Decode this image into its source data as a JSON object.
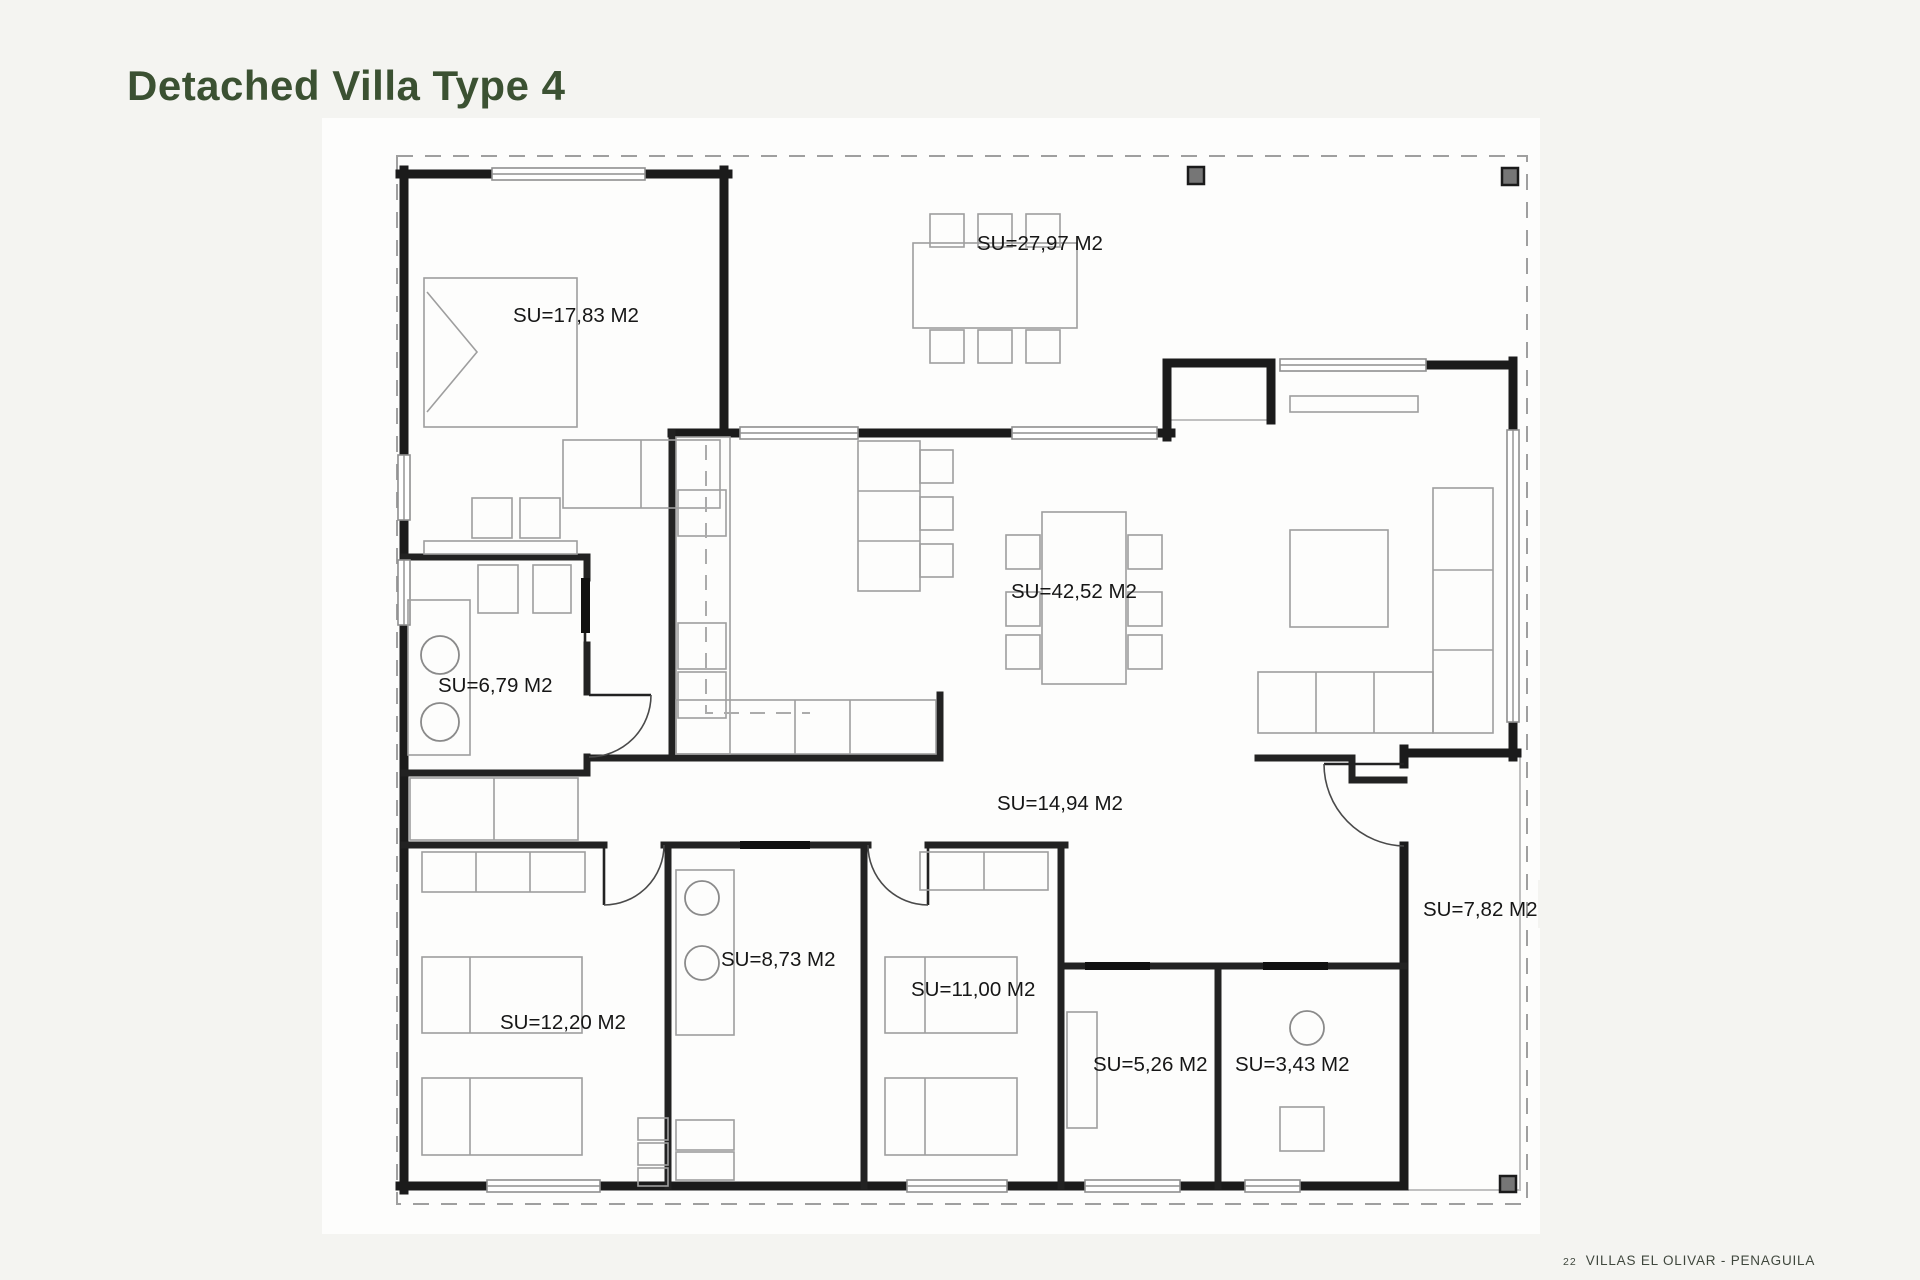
{
  "page": {
    "title": "Detached Villa Type 4",
    "background_color": "#f4f4f1",
    "title_color": "#3b5132"
  },
  "footer": {
    "page_number": "22",
    "project_name": "VILLAS EL OLIVAR - PENAGUILA"
  },
  "plan": {
    "area_unit": "M2",
    "rooms": [
      {
        "id": "bedroom-main",
        "label": "SU=17,83 M2",
        "area_m2": "17,83"
      },
      {
        "id": "terrace",
        "label": "SU=27,97 M2",
        "area_m2": "27,97"
      },
      {
        "id": "living-dining-kitchen",
        "label": "SU=42,52 M2",
        "area_m2": "42,52"
      },
      {
        "id": "bathroom-1",
        "label": "SU=6,79 M2",
        "area_m2": "6,79"
      },
      {
        "id": "hallway",
        "label": "SU=14,94 M2",
        "area_m2": "14,94"
      },
      {
        "id": "bathroom-2",
        "label": "SU=8,73 M2",
        "area_m2": "8,73"
      },
      {
        "id": "bedroom-2",
        "label": "SU=12,20 M2",
        "area_m2": "12,20"
      },
      {
        "id": "bedroom-3",
        "label": "SU=11,00 M2",
        "area_m2": "11,00"
      },
      {
        "id": "storage",
        "label": "SU=5,26 M2",
        "area_m2": "5,26"
      },
      {
        "id": "toilet",
        "label": "SU=3,43 M2",
        "area_m2": "3,43"
      },
      {
        "id": "entry-porch",
        "label": "SU=7,82 M2",
        "area_m2": "7,82"
      }
    ],
    "colors": {
      "walls": "#1b1b1b",
      "furniture": "#9e9e9e",
      "roof_overhang_dash": "#9f9f9f",
      "column_post": "#767676"
    }
  }
}
